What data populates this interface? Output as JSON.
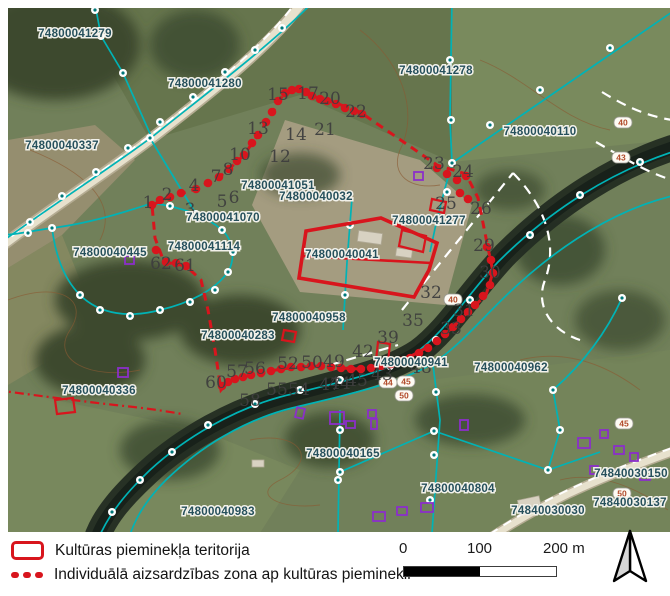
{
  "map": {
    "parcel_labels": [
      {
        "text": "74800041279",
        "x": 75,
        "y": 37
      },
      {
        "text": "74800041280",
        "x": 205,
        "y": 87
      },
      {
        "text": "74800041278",
        "x": 436,
        "y": 74
      },
      {
        "text": "74800040337",
        "x": 62,
        "y": 149
      },
      {
        "text": "74800040110",
        "x": 540,
        "y": 135
      },
      {
        "text": "74800041051",
        "x": 278,
        "y": 189
      },
      {
        "text": "74800040032",
        "x": 316,
        "y": 200
      },
      {
        "text": "74800041070",
        "x": 223,
        "y": 221
      },
      {
        "text": "74800041114",
        "x": 204,
        "y": 250
      },
      {
        "text": "74800040445",
        "x": 110,
        "y": 256
      },
      {
        "text": "74800041277",
        "x": 429,
        "y": 224
      },
      {
        "text": "74800040041",
        "x": 342,
        "y": 258
      },
      {
        "text": "74800040958",
        "x": 309,
        "y": 321
      },
      {
        "text": "74800040283",
        "x": 238,
        "y": 339
      },
      {
        "text": "74800040336",
        "x": 99,
        "y": 394
      },
      {
        "text": "74800040941",
        "x": 411,
        "y": 366
      },
      {
        "text": "74800040962",
        "x": 511,
        "y": 371
      },
      {
        "text": "74800040165",
        "x": 343,
        "y": 457
      },
      {
        "text": "74800040804",
        "x": 458,
        "y": 492
      },
      {
        "text": "74800040983",
        "x": 218,
        "y": 515
      },
      {
        "text": "74840030150",
        "x": 631,
        "y": 477
      },
      {
        "text": "74840030137",
        "x": 630,
        "y": 506
      },
      {
        "text": "74840030030",
        "x": 548,
        "y": 514
      }
    ],
    "point_numbers": [
      {
        "text": "1",
        "x": 148,
        "y": 208
      },
      {
        "text": "2",
        "x": 167,
        "y": 200
      },
      {
        "text": "3",
        "x": 190,
        "y": 215
      },
      {
        "text": "4",
        "x": 194,
        "y": 191
      },
      {
        "text": "5",
        "x": 222,
        "y": 207
      },
      {
        "text": "6",
        "x": 234,
        "y": 203
      },
      {
        "text": "7",
        "x": 216,
        "y": 182
      },
      {
        "text": "8",
        "x": 228,
        "y": 175
      },
      {
        "text": "10",
        "x": 240,
        "y": 160
      },
      {
        "text": "12",
        "x": 280,
        "y": 162
      },
      {
        "text": "13",
        "x": 258,
        "y": 134
      },
      {
        "text": "14",
        "x": 296,
        "y": 140
      },
      {
        "text": "15",
        "x": 278,
        "y": 100
      },
      {
        "text": "17",
        "x": 308,
        "y": 99
      },
      {
        "text": "20",
        "x": 330,
        "y": 104
      },
      {
        "text": "21",
        "x": 325,
        "y": 135
      },
      {
        "text": "22",
        "x": 356,
        "y": 117
      },
      {
        "text": "23",
        "x": 434,
        "y": 169
      },
      {
        "text": "24",
        "x": 463,
        "y": 177
      },
      {
        "text": "25",
        "x": 446,
        "y": 209
      },
      {
        "text": "26",
        "x": 481,
        "y": 214
      },
      {
        "text": "29",
        "x": 484,
        "y": 251
      },
      {
        "text": "30",
        "x": 490,
        "y": 278
      },
      {
        "text": "31",
        "x": 464,
        "y": 316
      },
      {
        "text": "32",
        "x": 431,
        "y": 298
      },
      {
        "text": "33",
        "x": 451,
        "y": 334
      },
      {
        "text": "35",
        "x": 413,
        "y": 326
      },
      {
        "text": "39",
        "x": 388,
        "y": 343
      },
      {
        "text": "42",
        "x": 363,
        "y": 357
      },
      {
        "text": "43",
        "x": 382,
        "y": 380
      },
      {
        "text": "44",
        "x": 340,
        "y": 389
      },
      {
        "text": "45",
        "x": 357,
        "y": 386
      },
      {
        "text": "47",
        "x": 330,
        "y": 390
      },
      {
        "text": "48",
        "x": 421,
        "y": 373
      },
      {
        "text": "49",
        "x": 334,
        "y": 367
      },
      {
        "text": "50",
        "x": 312,
        "y": 368
      },
      {
        "text": "52",
        "x": 288,
        "y": 369
      },
      {
        "text": "54",
        "x": 299,
        "y": 395
      },
      {
        "text": "55",
        "x": 277,
        "y": 395
      },
      {
        "text": "56",
        "x": 255,
        "y": 374
      },
      {
        "text": "57",
        "x": 237,
        "y": 377
      },
      {
        "text": "58",
        "x": 250,
        "y": 406
      },
      {
        "text": "60",
        "x": 216,
        "y": 388
      },
      {
        "text": "61",
        "x": 185,
        "y": 271
      },
      {
        "text": "62",
        "x": 161,
        "y": 269
      }
    ],
    "elevation_badges": [
      {
        "text": "40",
        "x": 623,
        "y": 123
      },
      {
        "text": "43",
        "x": 621,
        "y": 158
      },
      {
        "text": "40",
        "x": 453,
        "y": 300
      },
      {
        "text": "44",
        "x": 388,
        "y": 383
      },
      {
        "text": "45",
        "x": 406,
        "y": 382
      },
      {
        "text": "50",
        "x": 404,
        "y": 396
      },
      {
        "text": "45",
        "x": 624,
        "y": 424
      },
      {
        "text": "50",
        "x": 622,
        "y": 494
      }
    ]
  },
  "legend": {
    "territory_label": "Kultūras pieminekļa teritorija",
    "zone_label": "Individuālā aizsardzības zona ap kultūras pieminekli"
  },
  "scalebar": {
    "start": "0",
    "mid": "100",
    "end": "200 m"
  },
  "colors": {
    "monument_red": "#d8151d",
    "parcel_teal": "#00b3b6",
    "building_purple": "#8b2fc9",
    "label_blue": "#26505c"
  }
}
